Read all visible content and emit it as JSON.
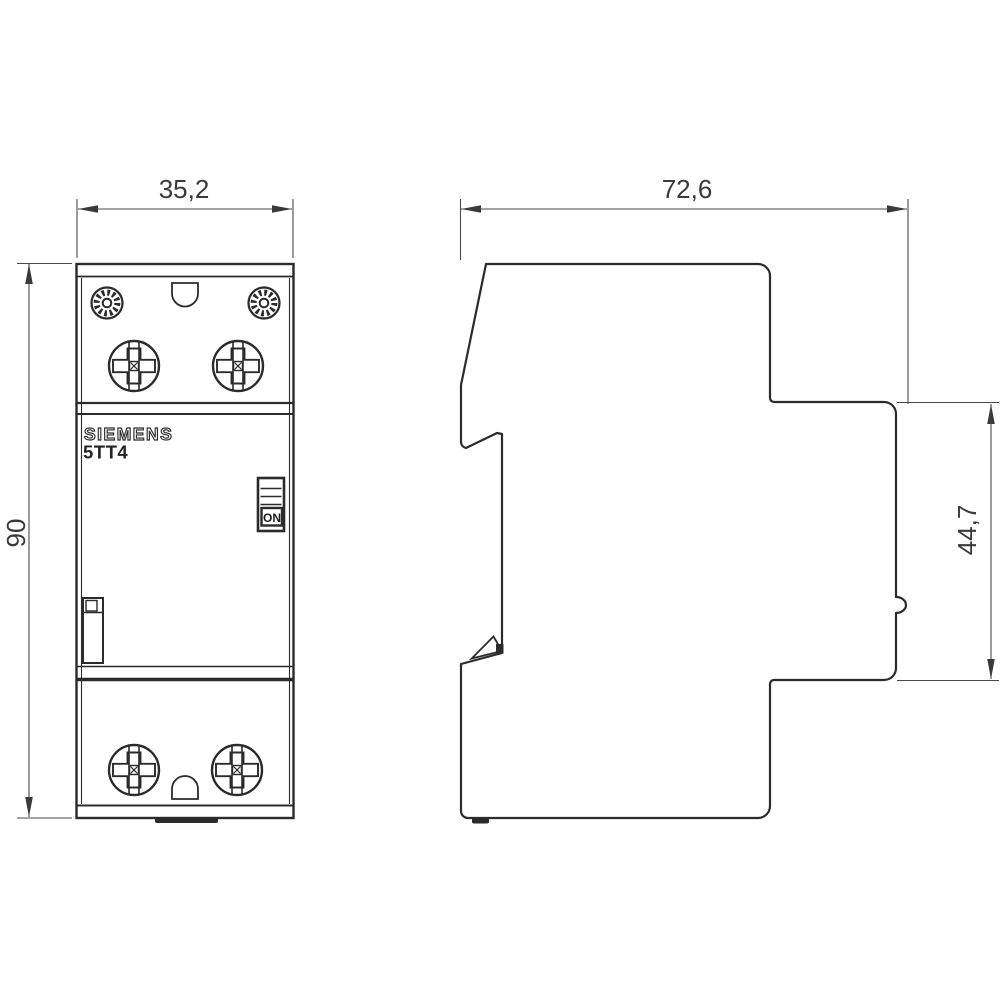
{
  "product": {
    "brand": "SIEMENS",
    "model": "5TT4",
    "switch_label": "ON"
  },
  "dimensions_mm": {
    "front_width": "35,2",
    "overall_height": "90",
    "total_depth": "72,6",
    "front_section_depth": "44,7"
  },
  "colors": {
    "background": "#ffffff",
    "outline": "#2b2b2b",
    "dimension_lines": "#4a4a4a",
    "dimension_text": "#3a3a3a"
  }
}
